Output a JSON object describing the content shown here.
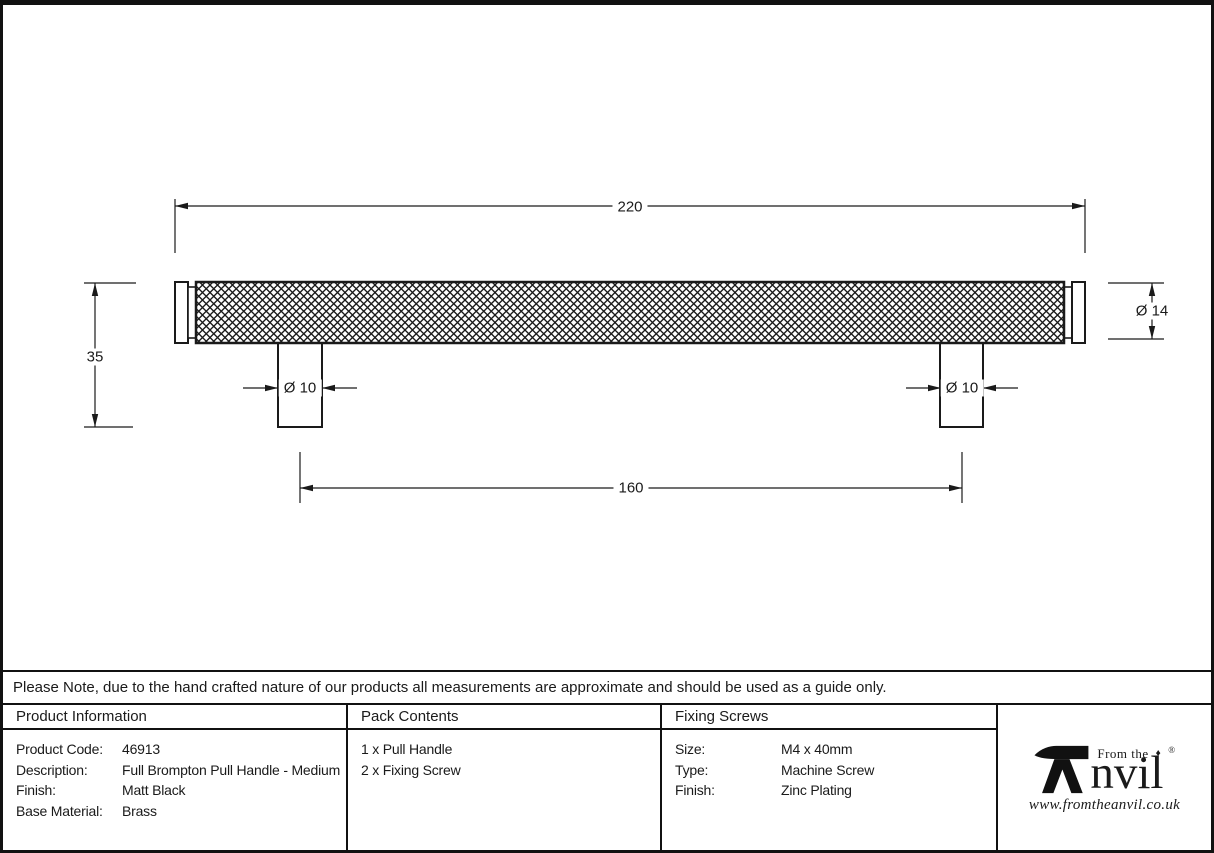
{
  "drawing": {
    "dimensions": {
      "overall_length": "220",
      "projection_height": "35",
      "bar_diameter": "Ø 14",
      "leg_diameter_left": "Ø 10",
      "leg_diameter_right": "Ø 10",
      "fixing_centres": "160"
    }
  },
  "note": "Please Note, due to the hand crafted nature of our products all measurements are approximate and should be used as a guide only.",
  "table": {
    "product_information": {
      "header": "Product Information",
      "rows": [
        {
          "label": "Product Code:",
          "value": "46913"
        },
        {
          "label": "Description:",
          "value": "Full Brompton Pull Handle - Medium"
        },
        {
          "label": "Finish:",
          "value": "Matt Black"
        },
        {
          "label": "Base Material:",
          "value": "Brass"
        }
      ]
    },
    "pack_contents": {
      "header": "Pack Contents",
      "items": [
        "1 x Pull Handle",
        "2 x Fixing Screw"
      ]
    },
    "fixing_screws": {
      "header": "Fixing Screws",
      "rows": [
        {
          "label": "Size:",
          "value": "M4 x 40mm"
        },
        {
          "label": "Type:",
          "value": "Machine Screw"
        },
        {
          "label": "Finish:",
          "value": "Zinc Plating"
        }
      ]
    }
  },
  "logo": {
    "prefix": "From the",
    "diamond": "♦",
    "name_rest": "nvil",
    "registered": "®",
    "url": "www.fromtheanvil.co.uk"
  },
  "colors": {
    "line": "#1a1a1a",
    "background": "#ffffff"
  }
}
